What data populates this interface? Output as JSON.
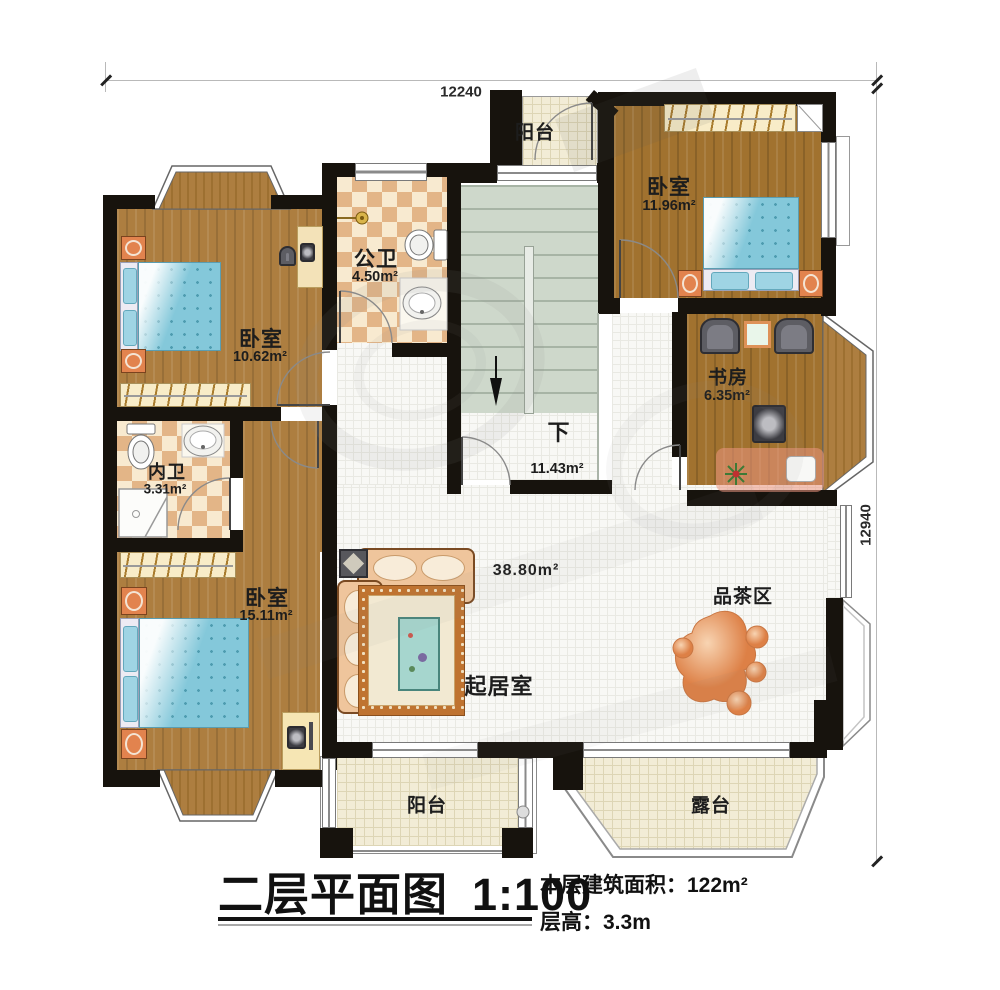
{
  "dimensions": {
    "top": "12240",
    "right": "12940"
  },
  "rooms": {
    "balcony_top": {
      "name": "阳台"
    },
    "bedroom_top_right": {
      "name": "卧室",
      "area": "11.96m²"
    },
    "public_bath": {
      "name": "公卫",
      "area": "4.50m²"
    },
    "stairs": {
      "label": "下",
      "area": "11.43m²"
    },
    "bedroom_top_left": {
      "name": "卧室",
      "area": "10.62m²"
    },
    "inner_bath": {
      "name": "内卫",
      "area": "3.31m²"
    },
    "bedroom_bottom_left": {
      "name": "卧室",
      "area": "15.11m²"
    },
    "study": {
      "name": "书房",
      "area": "6.35m²"
    },
    "living": {
      "name": "起居室",
      "area": "38.80m²"
    },
    "tea_area": {
      "name": "品茶区"
    },
    "balcony_bottom": {
      "name": "阳台"
    },
    "terrace": {
      "name": "露台"
    }
  },
  "title_block": {
    "title": "二层平面图",
    "scale": "1:100",
    "floor_area": "本层建筑面积：122m²",
    "floor_height": "层高：3.3m"
  },
  "colors": {
    "wall": "#17130d",
    "wood": "#ad7e40",
    "tile": "#f2ecd6",
    "bed_blue": "#84c8da",
    "stand_orange": "#e2834e"
  }
}
